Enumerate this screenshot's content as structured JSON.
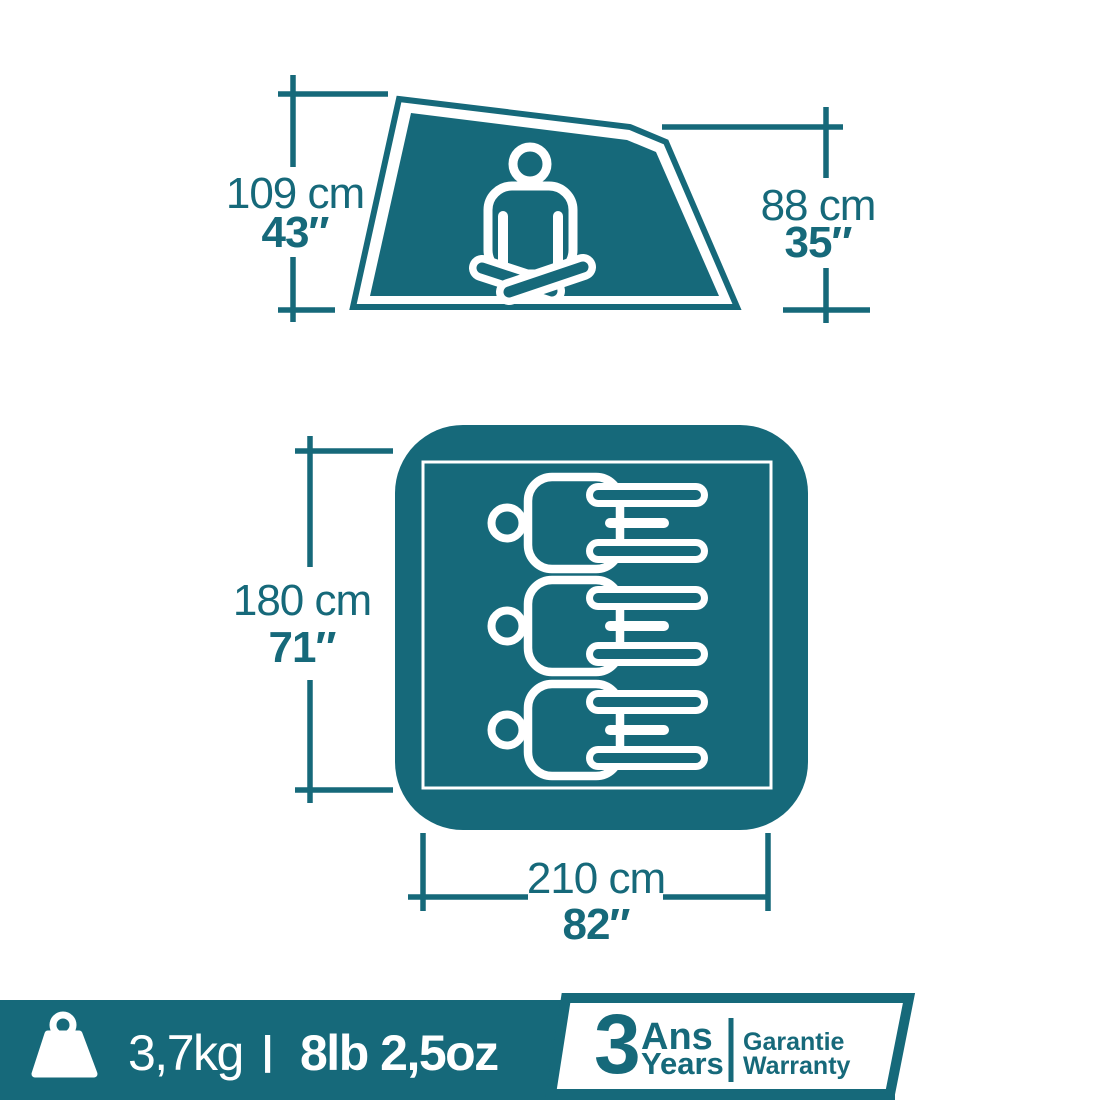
{
  "colors": {
    "teal": "#16697A",
    "white": "#ffffff"
  },
  "side_view": {
    "peak_height": {
      "metric": "109 cm",
      "imperial": "43″"
    },
    "rear_height": {
      "metric": "88 cm",
      "imperial": "35″"
    }
  },
  "floor_view": {
    "width": {
      "metric": "180 cm",
      "imperial": "71″"
    },
    "length": {
      "metric": "210 cm",
      "imperial": "82″"
    },
    "sleeping_capacity": 3
  },
  "footer": {
    "weight_metric": "3,7kg",
    "separator": "|",
    "weight_imperial": "8lb 2,5oz",
    "warranty_badge": {
      "years_number": "3",
      "years_label_fr": "Ans",
      "years_label_en": "Years",
      "guarantee_fr": "Garantie",
      "guarantee_en": "Warranty"
    }
  },
  "icons": {
    "seated_person": "seated-person-icon",
    "lying_person": "lying-person-icon",
    "weight": "weight-icon"
  }
}
